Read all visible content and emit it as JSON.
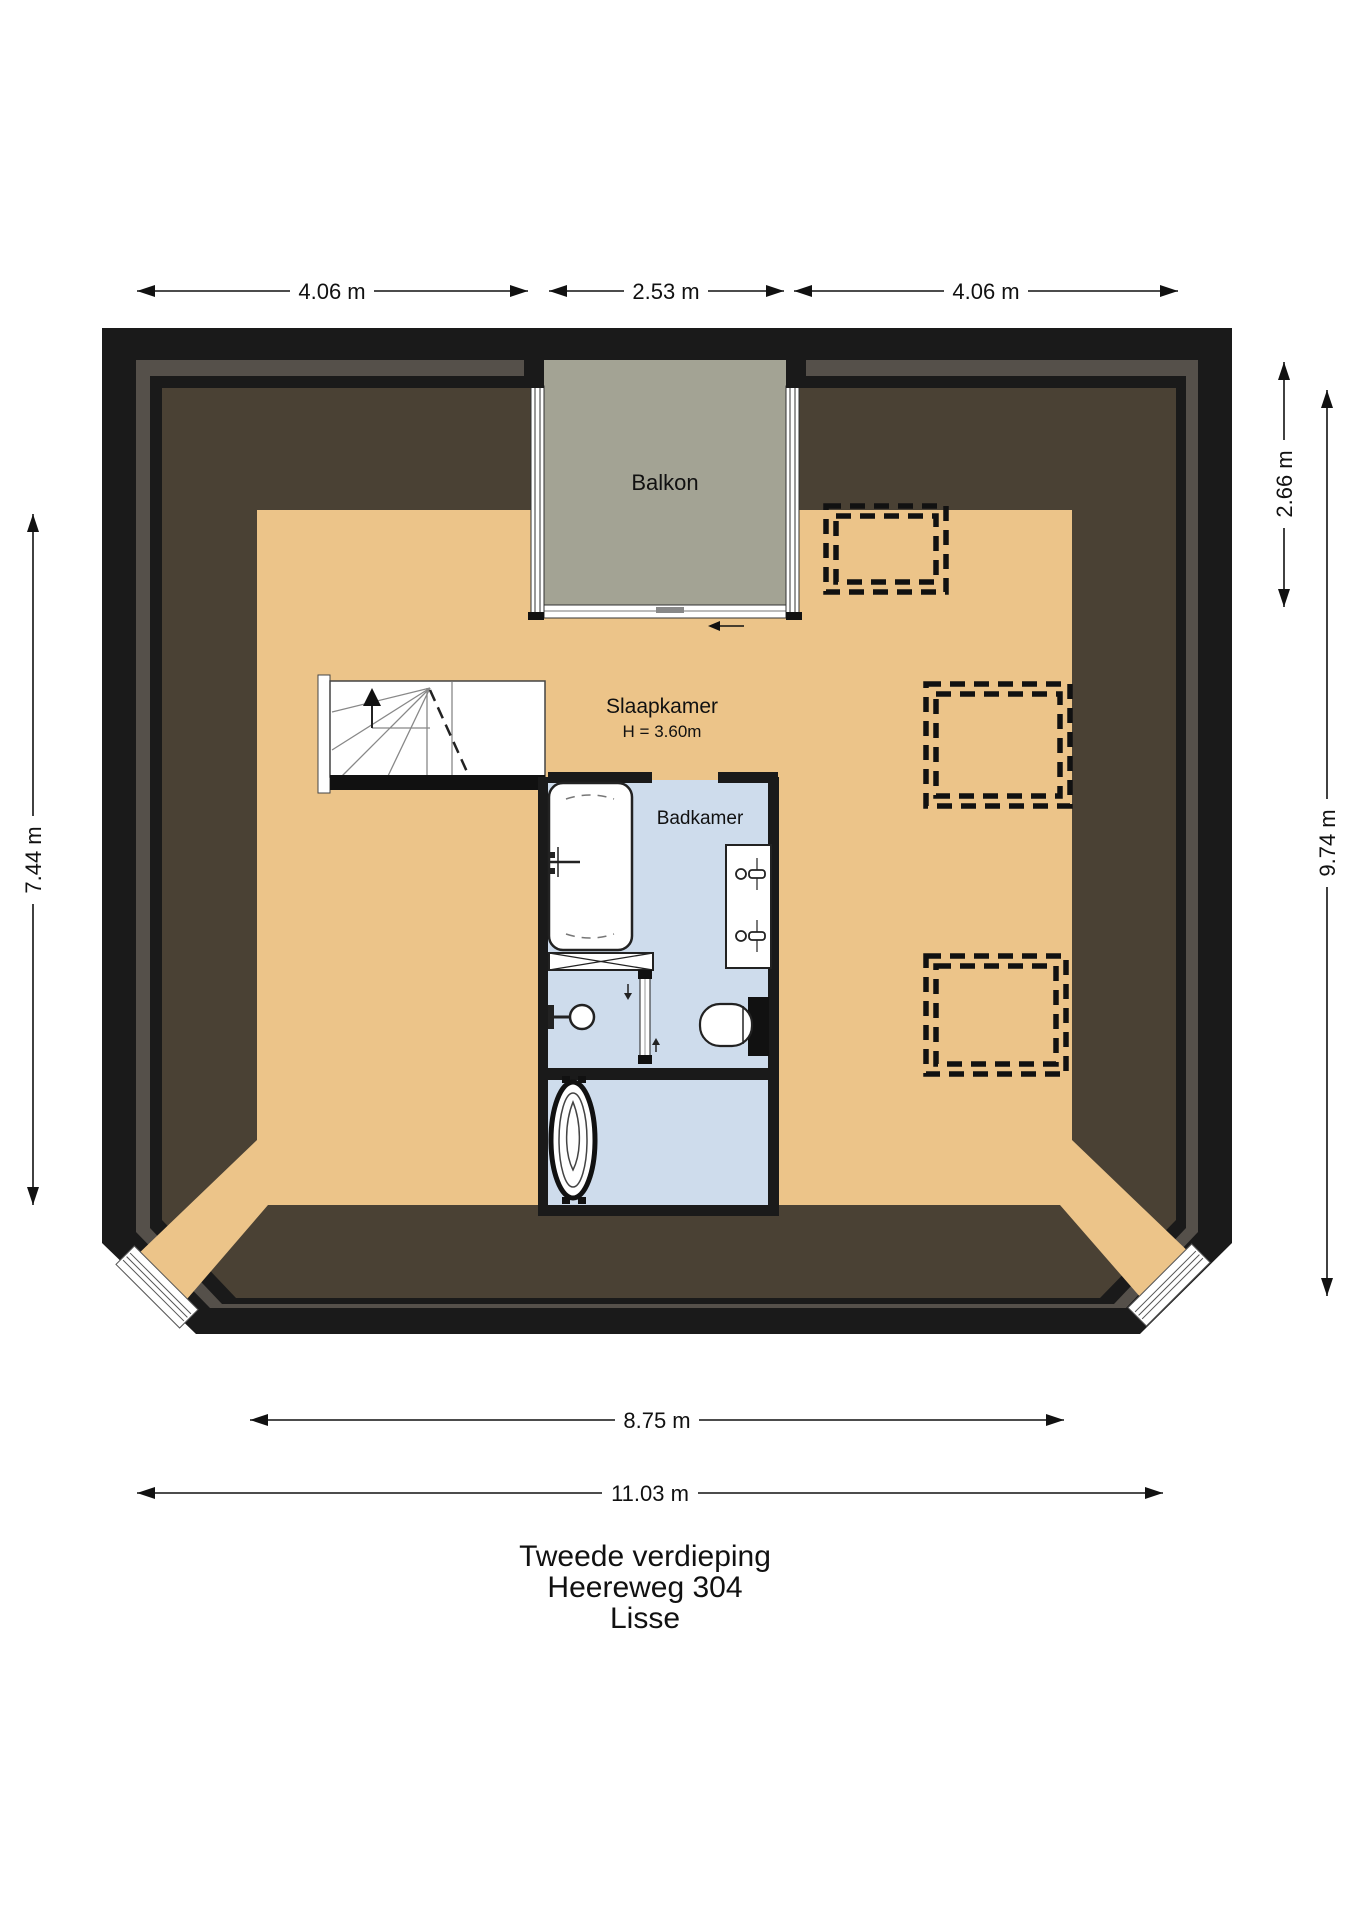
{
  "title": {
    "line1": "Tweede verdieping",
    "line2": "Heereweg 304",
    "line3": "Lisse"
  },
  "rooms": {
    "balcony": "Balkon",
    "bedroom": "Slaapkamer",
    "bedroom_height": "H = 3.60m",
    "bathroom": "Badkamer"
  },
  "dimensions": {
    "top_left": "4.06 m",
    "top_middle": "2.53 m",
    "top_right": "4.06 m",
    "left_side": "7.44 m",
    "right_upper": "2.66 m",
    "right_full": "9.74 m",
    "bottom_inner": "8.75 m",
    "bottom_outer": "11.03 m"
  },
  "colors": {
    "wall": "#1a1a1a",
    "roof_stripe": "#55504a",
    "roof_dark": "#4a4134",
    "floor_tan": "#ecc489",
    "balcony_gray": "#a3a394",
    "bathroom_blue": "#cedcec",
    "line": "#111111"
  }
}
